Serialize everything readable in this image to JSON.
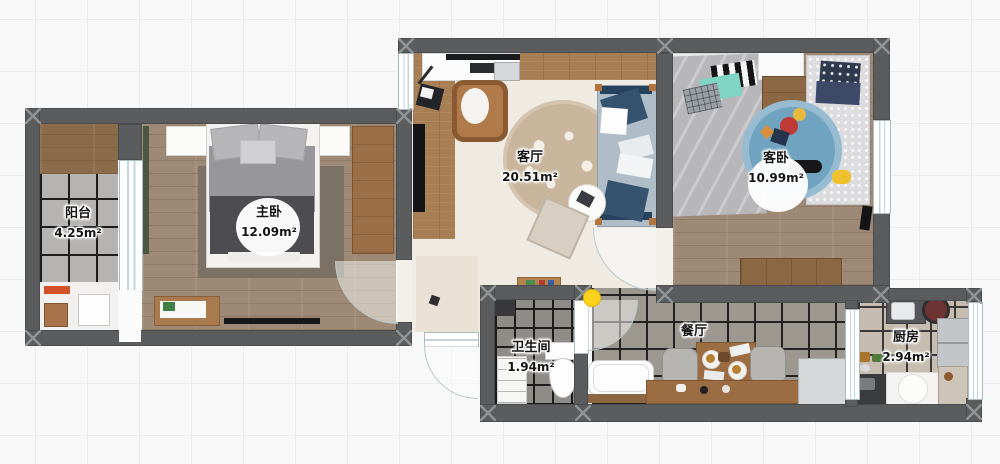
{
  "plan": {
    "rooms": [
      {
        "id": "balcony",
        "name": "阳台",
        "area": "4.25m²"
      },
      {
        "id": "master-bedroom",
        "name": "主卧",
        "area": "12.09m²"
      },
      {
        "id": "living-room",
        "name": "客厅",
        "area": "20.51m²"
      },
      {
        "id": "guest-bedroom",
        "name": "客卧",
        "area": "10.99m²"
      },
      {
        "id": "bathroom",
        "name": "卫生间",
        "area": "1.94m²"
      },
      {
        "id": "dining-room",
        "name": "餐厅"
      },
      {
        "id": "kitchen",
        "name": "厨房",
        "area": "2.94m²"
      }
    ],
    "colors": {
      "wall": "#5b5c5e",
      "marker_yellow": "#ffd21b",
      "door_arc": "#b7c9cb",
      "label_text": "#141414"
    }
  }
}
